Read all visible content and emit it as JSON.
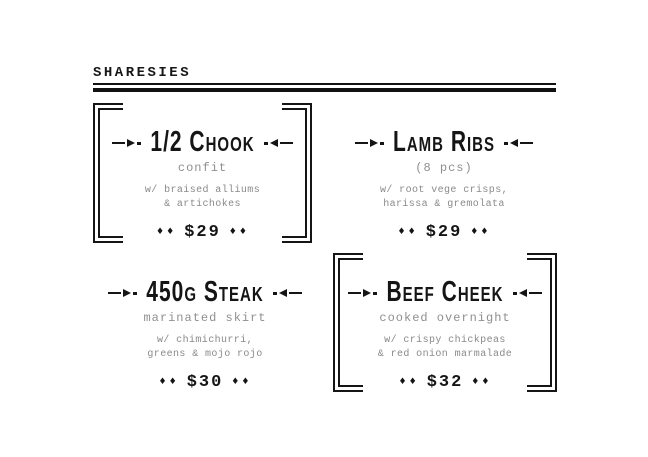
{
  "header": {
    "title": "SHARESIES"
  },
  "menu": {
    "price_ornament": "♦♦",
    "colors": {
      "ink": "#151515",
      "muted": "#8f8f8f",
      "background": "#ffffff"
    },
    "items": [
      {
        "title": "1/2 Chook",
        "subtitle": "confit",
        "desc_line1": "w/ braised alliums",
        "desc_line2": "& artichokes",
        "price": "$29",
        "framed": true
      },
      {
        "title": "Lamb Ribs",
        "subtitle": "(8 pcs)",
        "desc_line1": "w/ root vege crisps,",
        "desc_line2": "harissa & gremolata",
        "price": "$29",
        "framed": false
      },
      {
        "title": "450g Steak",
        "subtitle": "marinated skirt",
        "desc_line1": "w/ chimichurri,",
        "desc_line2": "greens & mojo rojo",
        "price": "$30",
        "framed": false
      },
      {
        "title": "Beef Cheek",
        "subtitle": "cooked overnight",
        "desc_line1": "w/ crispy chickpeas",
        "desc_line2": "& red onion marmalade",
        "price": "$32",
        "framed": true
      }
    ]
  }
}
